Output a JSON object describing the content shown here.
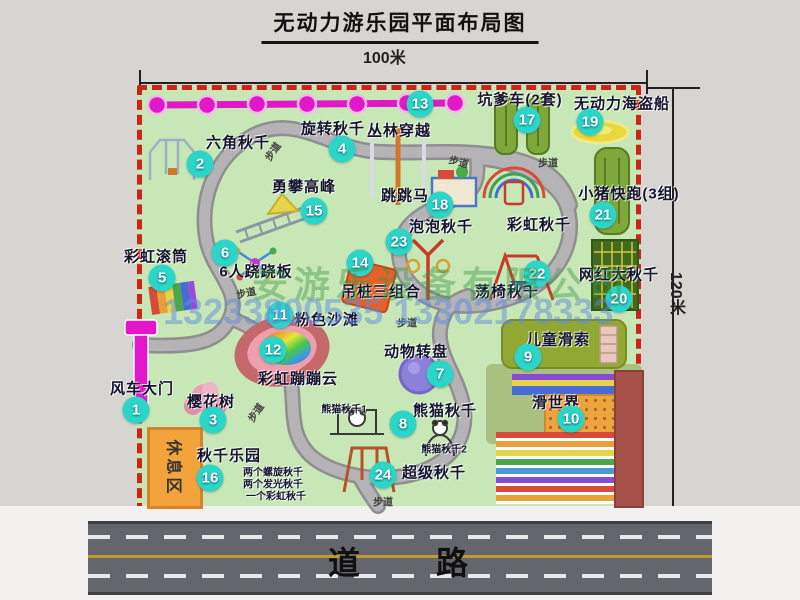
{
  "title": "无动力游乐园平面布局图",
  "dimensions": {
    "width_label": "100米",
    "height_label": "120米"
  },
  "watermark": {
    "company": "安游乐设备有限公司",
    "phone": "13233800535 13302178333"
  },
  "road": {
    "label": "道　　路"
  },
  "rest_area": {
    "label": "休息区"
  },
  "path_label": "步道",
  "colors": {
    "map_green": "#c8e7b6",
    "border_red": "#ce2415",
    "circle_teal": "#2bd5c8",
    "chain_magenta": "#e018c8",
    "rest_orange": "#f2a33c",
    "road_gray": "#65656d"
  },
  "attractions": [
    {
      "num": "1",
      "label": "风车大门"
    },
    {
      "num": "2",
      "label": "六角秋千"
    },
    {
      "num": "3",
      "label": "樱花树"
    },
    {
      "num": "4",
      "label": "旋转秋千"
    },
    {
      "num": "5",
      "label": "彩虹滚筒"
    },
    {
      "num": "6",
      "label": "6人跷跷板"
    },
    {
      "num": "7",
      "label": "动物转盘"
    },
    {
      "num": "8",
      "label": "熊猫秋千",
      "sublabels": [
        "熊猫秋千1",
        "熊猫秋千2"
      ]
    },
    {
      "num": "9",
      "label": "儿童滑索"
    },
    {
      "num": "10",
      "label": "滑世界"
    },
    {
      "num": "11",
      "label": "粉色沙滩"
    },
    {
      "num": "12",
      "label": "彩虹蹦蹦云"
    },
    {
      "num": "13",
      "label": "丛林穿越"
    },
    {
      "num": "14",
      "label": "吊桩三组合"
    },
    {
      "num": "15",
      "label": "勇攀高峰"
    },
    {
      "num": "16",
      "label": "秋千乐园",
      "sublabels": [
        "两个螺旋秋千",
        "两个发光秋千",
        "一个彩虹秋千"
      ]
    },
    {
      "num": "17",
      "label": "坑爹车(2套)"
    },
    {
      "num": "18",
      "label": "跳跳马"
    },
    {
      "num": "19",
      "label": "无动力海盗船"
    },
    {
      "num": "20",
      "label": "网红大秋千"
    },
    {
      "num": "21",
      "label": "小猪快跑(3组)"
    },
    {
      "num": "22",
      "label": "荡椅秋千"
    },
    {
      "num": "23",
      "label": "泡泡秋千"
    },
    {
      "num": "24",
      "label": "超级秋千"
    },
    {
      "num": "",
      "label": "彩虹秋千"
    }
  ]
}
